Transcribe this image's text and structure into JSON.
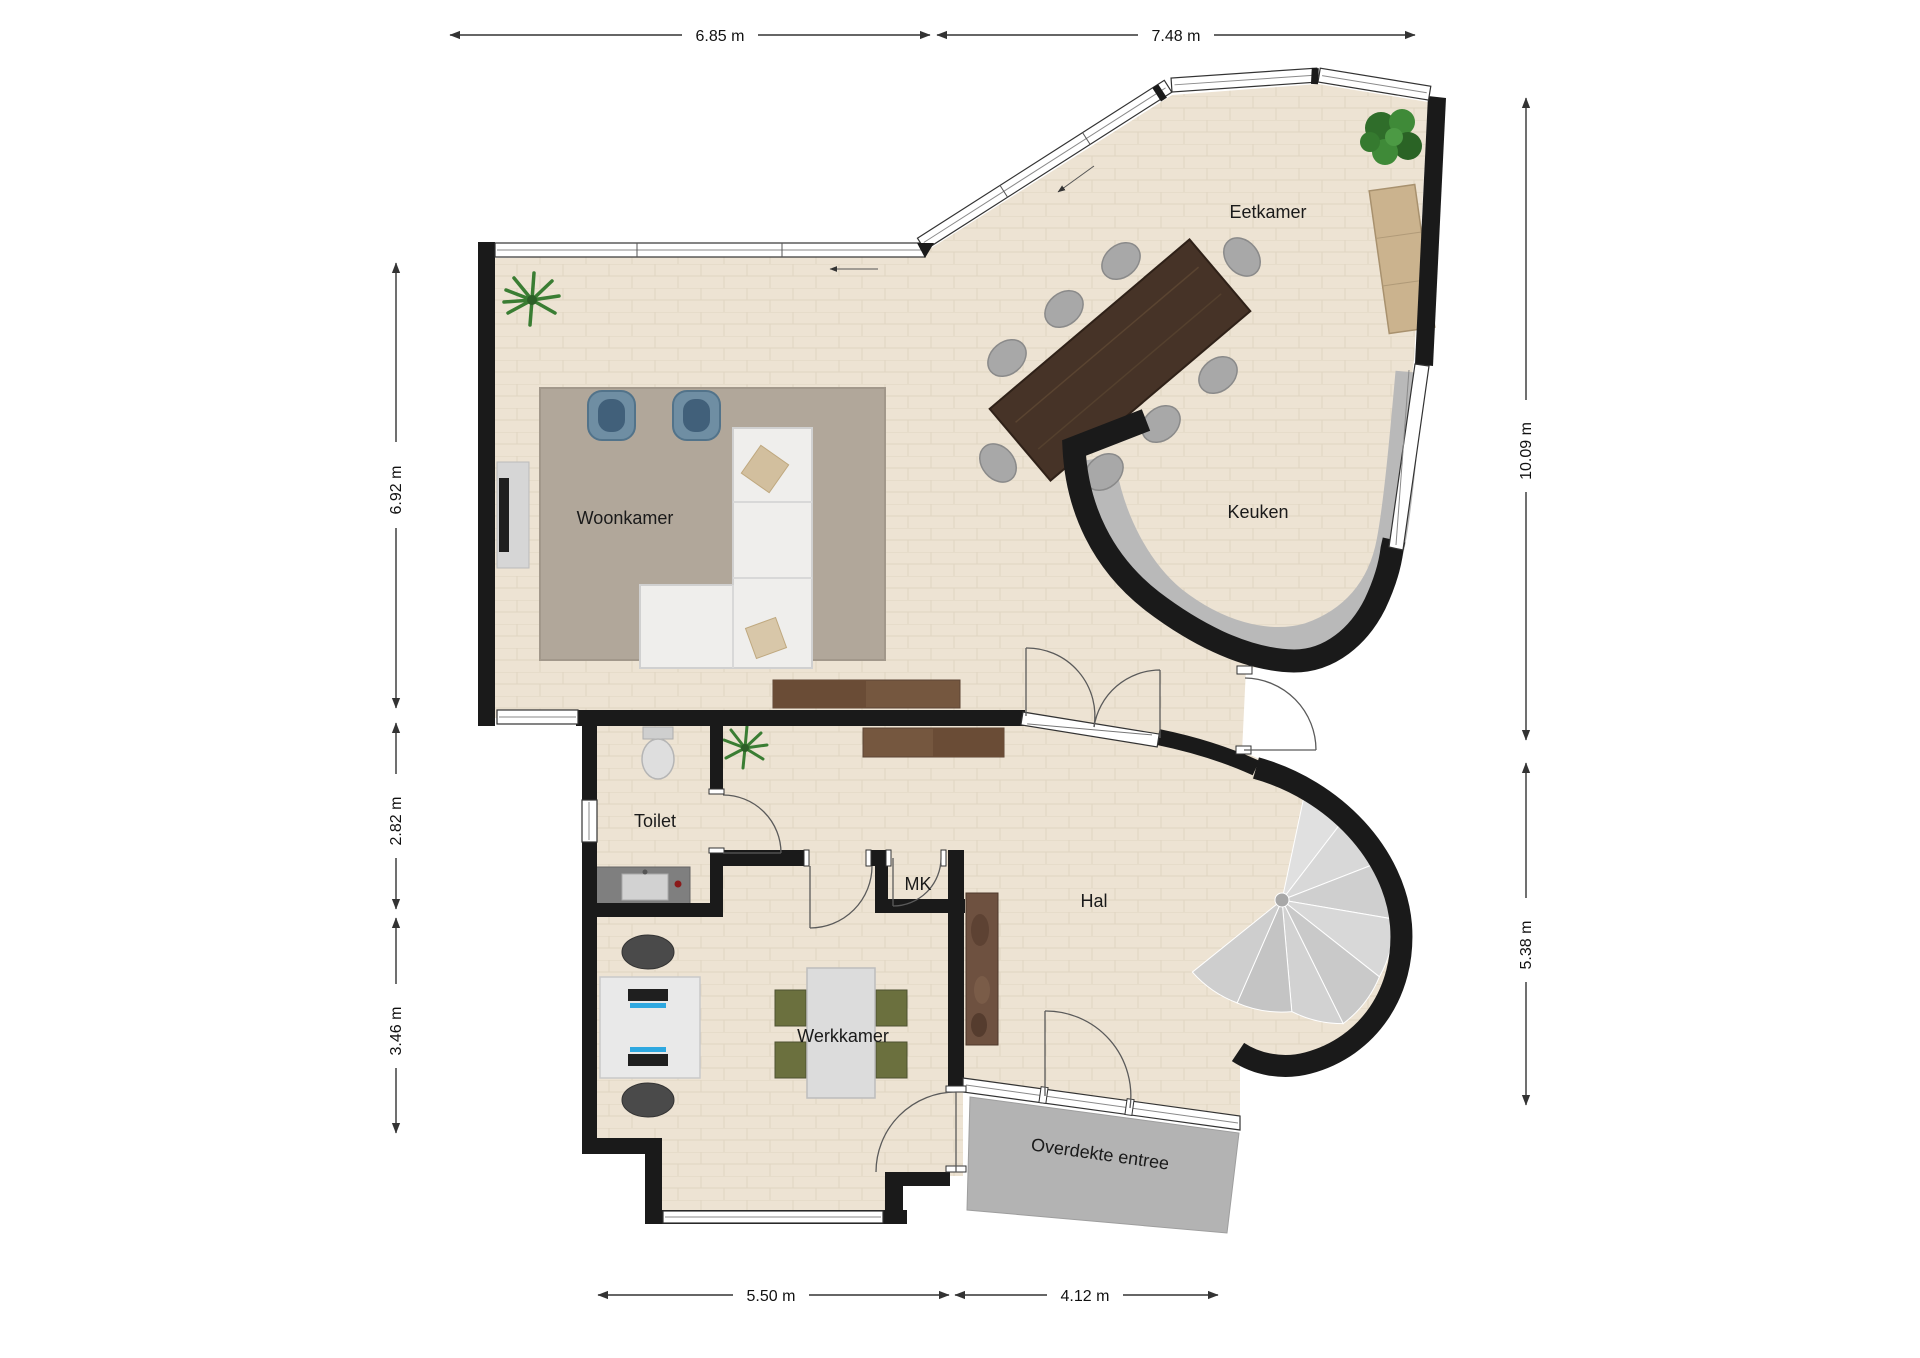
{
  "rooms": {
    "woonkamer": {
      "label": "Woonkamer"
    },
    "eetkamer": {
      "label": "Eetkamer"
    },
    "keuken": {
      "label": "Keuken"
    },
    "toilet": {
      "label": "Toilet"
    },
    "mk": {
      "label": "MK"
    },
    "hal": {
      "label": "Hal"
    },
    "werkkamer": {
      "label": "Werkkamer"
    },
    "entree": {
      "label": "Overdekte entree"
    }
  },
  "dimensions": {
    "top": [
      {
        "label": "6.85 m"
      },
      {
        "label": "7.48 m"
      }
    ],
    "right": [
      {
        "label": "10.09 m"
      },
      {
        "label": "5.38 m"
      }
    ],
    "left": [
      {
        "label": "6.92 m"
      },
      {
        "label": "2.82 m"
      },
      {
        "label": "3.46 m"
      }
    ],
    "bottom": [
      {
        "label": "5.50 m"
      },
      {
        "label": "4.12 m"
      }
    ]
  },
  "colors": {
    "wall": "#1a1a1a",
    "floor": "#ede3d3",
    "floor_line": "#e0d5c2",
    "counter": "#b9b9b9",
    "stair": "#d6d6d6",
    "entree_floor": "#b3b3b3",
    "rug": "#b1a79a",
    "sofa": "#efeeec",
    "armchair": "#6f8ea3",
    "armchair_dark": "#41607a",
    "table_wood": "#463327",
    "sideboard": "#75573f",
    "light_wood": "#cbb38e",
    "chair_gray": "#a8a8a8",
    "plant": "#3a7d33",
    "desk": "#e9e9e9",
    "monitor": "#1f1f1f",
    "monitor_accent": "#2ea8e0",
    "work_chair": "#6b703e",
    "office_chair": "#4a4a4a",
    "dim": "#333333",
    "label": "#1a1a1a"
  }
}
